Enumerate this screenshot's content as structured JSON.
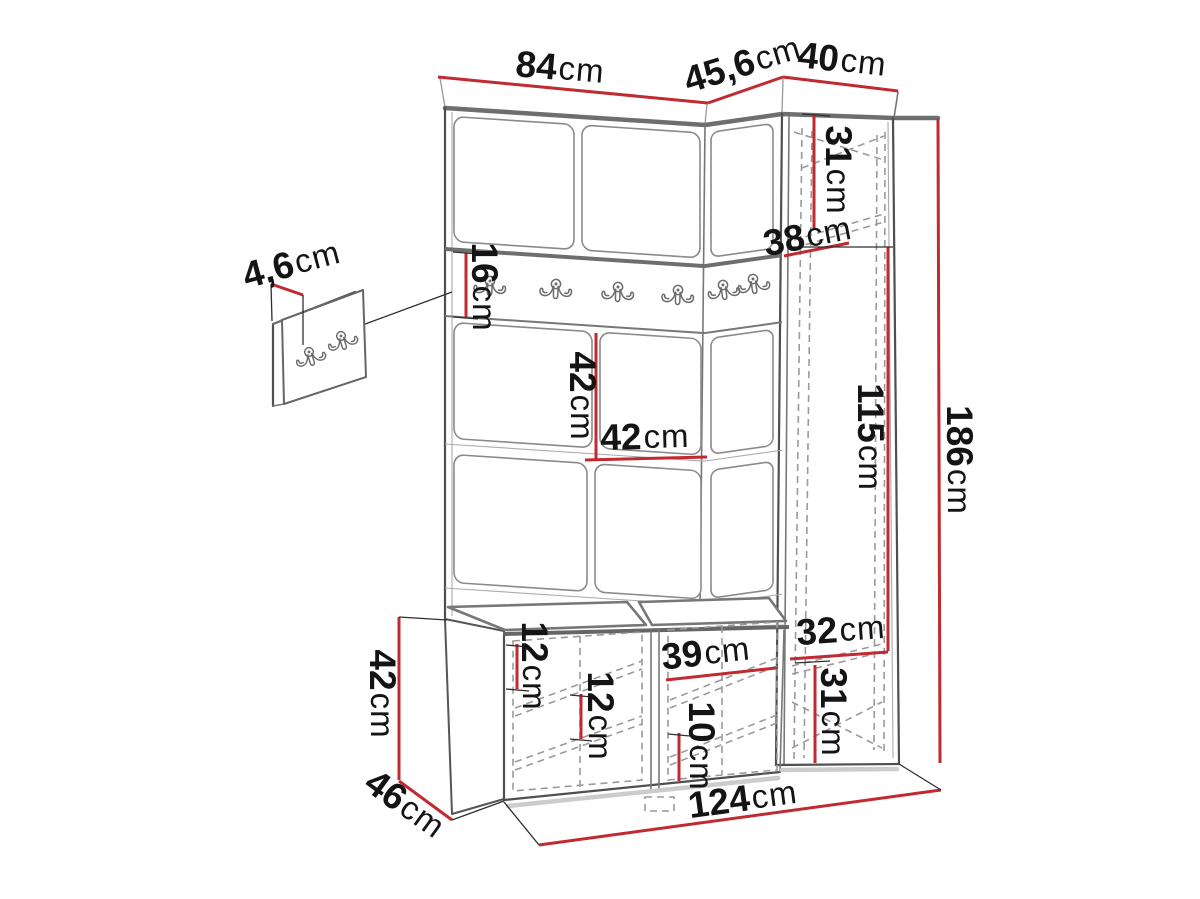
{
  "diagram": {
    "type": "furniture-dimension-diagram",
    "subject": "hallway set: panel wall with coat hooks, corner cabinet and shoe bench",
    "unit": "cm",
    "colors": {
      "dimension_red": "#c02a30",
      "outline_dark": "#4f4f4f",
      "outline_mid": "#777777",
      "hidden_dashed": "#9a9a9a",
      "label_text": "#141414",
      "background": "#ffffff",
      "shadow": "#cccccc"
    },
    "hook_rail": {
      "hook_count": 6
    },
    "detail_panel": {
      "hook_count": 2
    },
    "dims": {
      "front_width": {
        "v": "84",
        "u": "cm"
      },
      "corner_width": {
        "v": "45,6",
        "u": "cm"
      },
      "cabinet_width": {
        "v": "40",
        "u": "cm"
      },
      "cabinet_top_section_height": {
        "v": "31",
        "u": "cm"
      },
      "cabinet_depth": {
        "v": "38",
        "u": "cm"
      },
      "hook_rail_height": {
        "v": "16",
        "u": "cm"
      },
      "panel_section_height": {
        "v": "42",
        "u": "cm"
      },
      "panel_section_width": {
        "v": "42",
        "u": "cm"
      },
      "cabinet_middle_section_height": {
        "v": "115",
        "u": "cm"
      },
      "total_height": {
        "v": "186",
        "u": "cm"
      },
      "hook_panel_thickness": {
        "v": "4,6",
        "u": "cm"
      },
      "bench_top_shelf_gap": {
        "v": "12",
        "u": "cm"
      },
      "bench_middle_shelf_gap": {
        "v": "12",
        "u": "cm"
      },
      "bench_shelf_width": {
        "v": "39",
        "u": "cm"
      },
      "bench_bottom_shelf_gap": {
        "v": "10",
        "u": "cm"
      },
      "cabinet_shelf_depth": {
        "v": "32",
        "u": "cm"
      },
      "cabinet_bottom_section_height": {
        "v": "31",
        "u": "cm"
      },
      "bench_height": {
        "v": "42",
        "u": "cm"
      },
      "bench_depth": {
        "v": "46",
        "u": "cm"
      },
      "total_width": {
        "v": "124",
        "u": "cm"
      }
    }
  }
}
